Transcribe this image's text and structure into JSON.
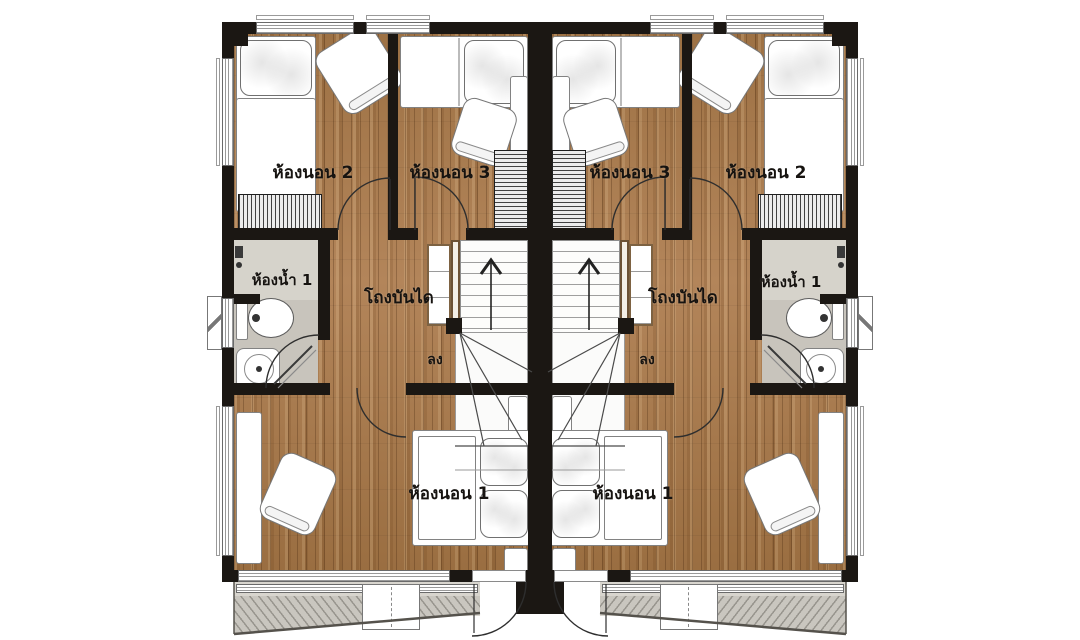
{
  "rooms": {
    "bedroom1": "ห้องนอน 1",
    "bedroom2": "ห้องนอน 2",
    "bedroom3": "ห้องนอน 3",
    "bathroom1": "ห้องน้ำ 1",
    "stair_hall": "โถงบันได",
    "down": "ลง"
  },
  "colors": {
    "wall": "#1b1713",
    "wood_floor": "#a87b4d",
    "bathroom_tile": "#c8c4bc",
    "stair_area": "#fbfbfa",
    "balcony_floor": "#d8d5ce",
    "furniture": "#ffffff"
  }
}
